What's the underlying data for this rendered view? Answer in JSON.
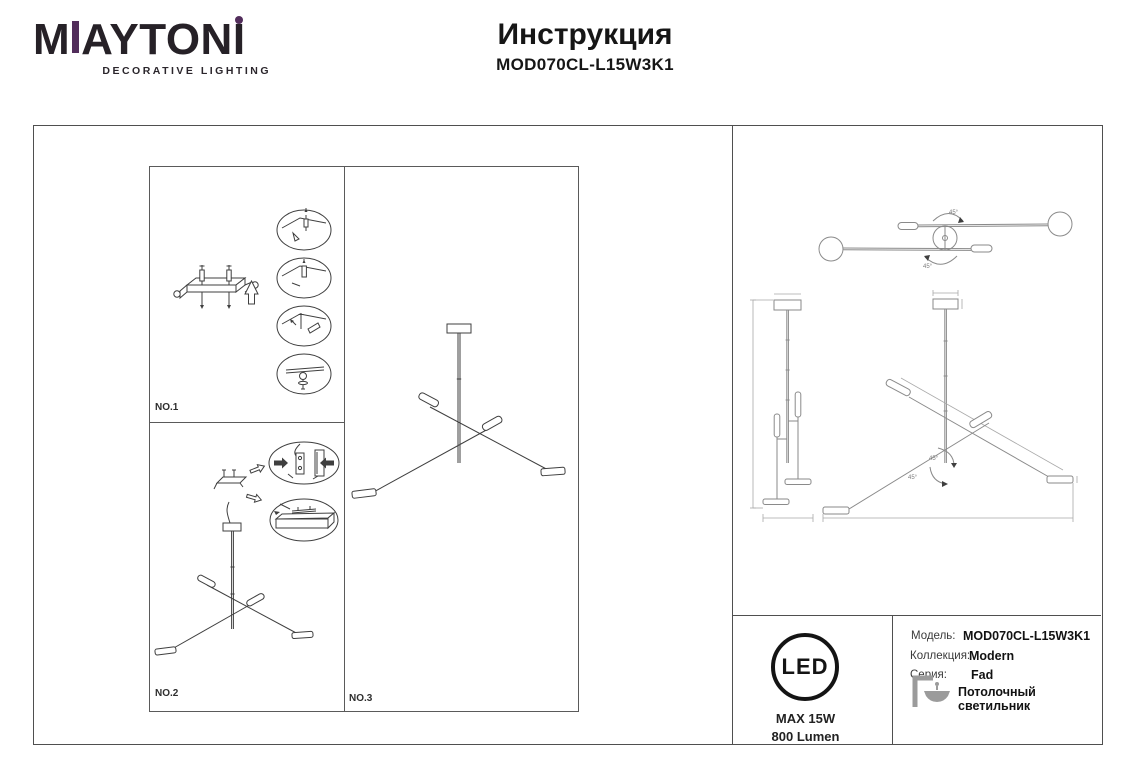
{
  "brand": {
    "letter_m": "M",
    "letters_mid": "AYTON",
    "letter_i": "I",
    "tagline": "DECORATIVE LIGHTING",
    "accent_color": "#522d5b"
  },
  "header": {
    "title": "Инструкция",
    "model": "MOD070CL-L15W3K1"
  },
  "assembly": {
    "step1_label": "NO.1",
    "step2_label": "NO.2",
    "step3_label": "NO.3"
  },
  "technical": {
    "rotation_angle": "45°"
  },
  "spec": {
    "led_label": "LED",
    "max_power": "MAX 15W",
    "luminous_flux": "800 Lumen"
  },
  "info": {
    "model_label": "Модель:",
    "model_value": "MOD070CL-L15W3K1",
    "collection_label": "Коллекция:",
    "collection_value": "Modern",
    "series_label": "Серия:",
    "series_value": "Fad",
    "type_value": "Потолочный светильник"
  }
}
